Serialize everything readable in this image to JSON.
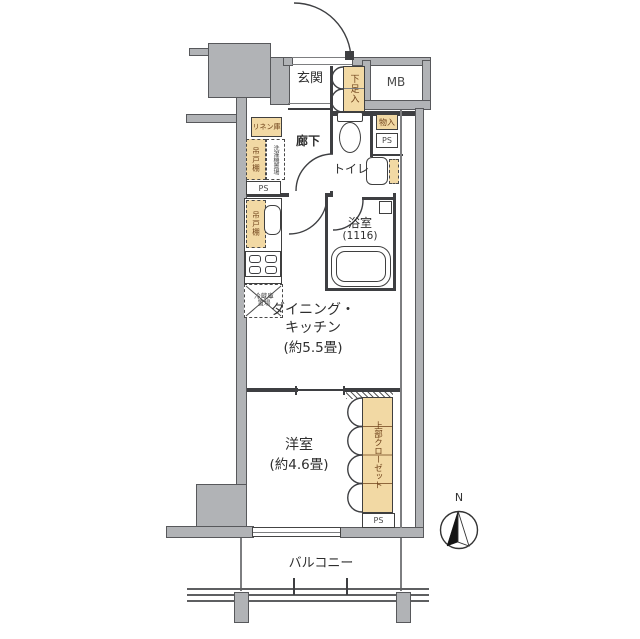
{
  "labels": {
    "genkan": "玄関",
    "shoe_box": "下足入",
    "meter_box": "MB",
    "linen": "リネン庫",
    "hallway": "廊下",
    "toilet": "トイレ",
    "storage": "物入",
    "ps": "PS",
    "hanging_cabinet": "吊戸棚",
    "washer_space": "洗濯機置場",
    "fridge_l1": "冷蔵庫",
    "fridge_l2": "置場",
    "bath": "浴室",
    "bath_size": "(1116)",
    "dk_l1": "ダイニング・",
    "dk_l2": "キッチン",
    "dk_size": "(約5.5畳)",
    "western_room": "洋室",
    "western_size": "(約4.6畳)",
    "upper_closet": "上部クローゼット",
    "balcony": "バルコニー",
    "north": "N"
  },
  "colors": {
    "wall": "#b1b3b6",
    "fixture_fill": "#f2d9a4",
    "line": "#3e3f42",
    "brown_text": "#6e4119"
  }
}
